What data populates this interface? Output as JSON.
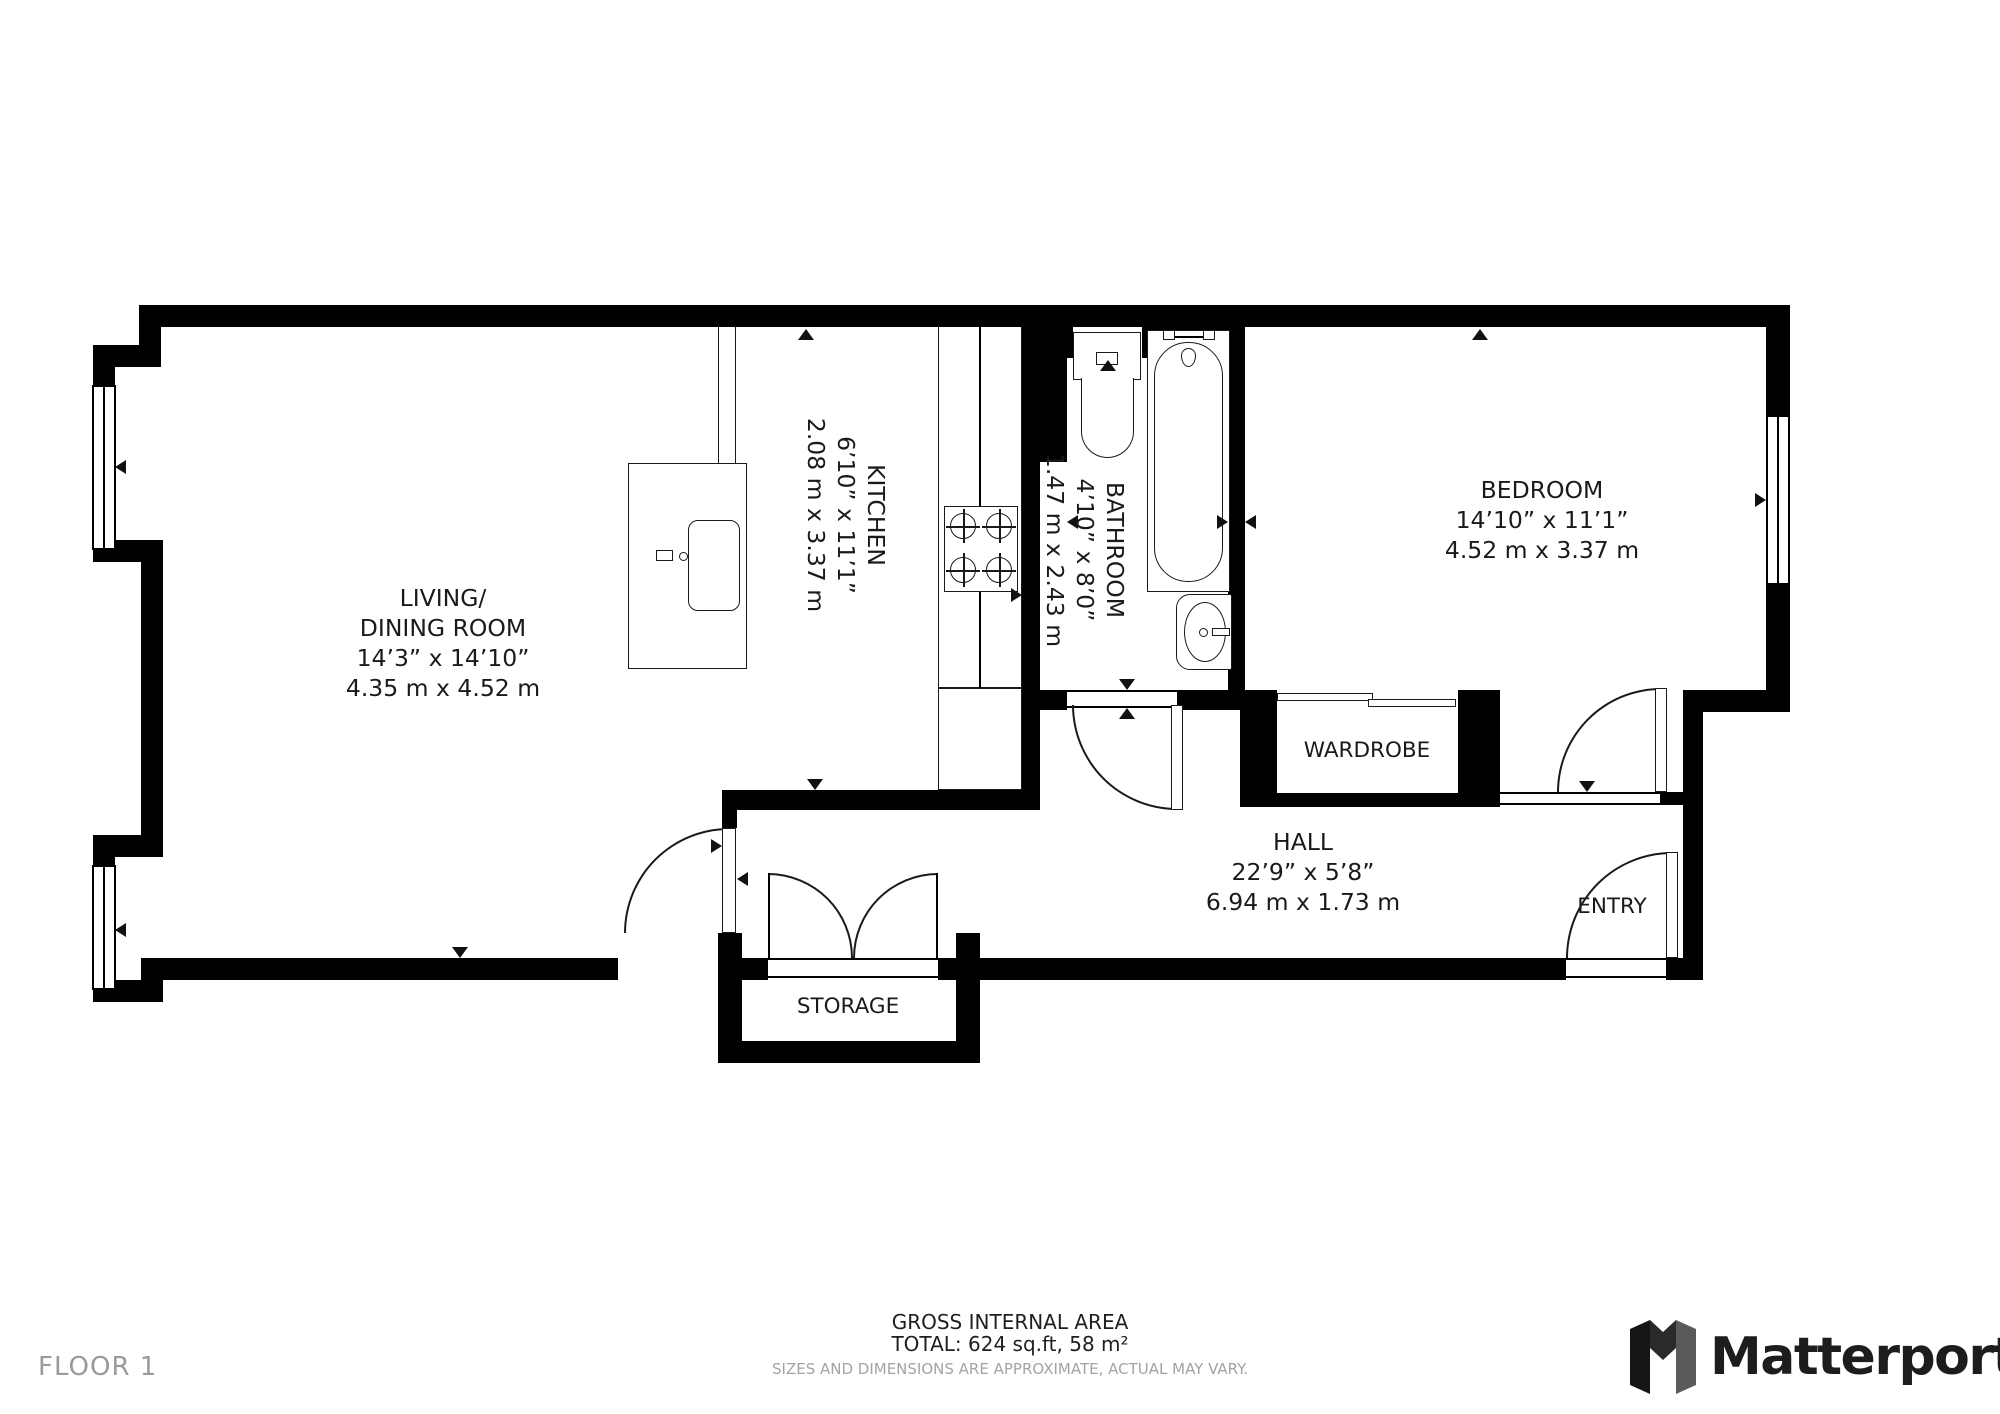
{
  "plan": {
    "floor": "FLOOR 1",
    "rooms": {
      "living": {
        "name_line1": "LIVING/",
        "name_line2": "DINING ROOM",
        "dim_ft": "14’3” x 14’10”",
        "dim_m": "4.35 m x 4.52 m"
      },
      "kitchen": {
        "name": "KITCHEN",
        "dim_ft": "6’10” x 11’1”",
        "dim_m": "2.08 m x 3.37 m"
      },
      "bathroom": {
        "name": "BATHROOM",
        "dim_ft": "4’10” x 8’0”",
        "dim_m": "1.47 m x 2.43 m"
      },
      "bedroom": {
        "name": "BEDROOM",
        "dim_ft": "14’10” x 11’1”",
        "dim_m": "4.52 m x 3.37 m"
      },
      "hall": {
        "name": "HALL",
        "dim_ft": "22’9” x 5’8”",
        "dim_m": "6.94 m x 1.73 m"
      },
      "wardrobe": {
        "name": "WARDROBE"
      },
      "entry": {
        "name": "ENTRY"
      },
      "storage": {
        "name": "STORAGE"
      }
    }
  },
  "footer": {
    "area_title": "GROSS INTERNAL AREA",
    "area_total": "TOTAL: 624 sq.ft, 58 m²",
    "disclaimer": "SIZES AND DIMENSIONS ARE APPROXIMATE, ACTUAL MAY VARY.",
    "brand": "Matterport"
  },
  "colors": {
    "wall": "#000000",
    "label": "#1a1a1a",
    "muted": "#9a9a9a"
  }
}
